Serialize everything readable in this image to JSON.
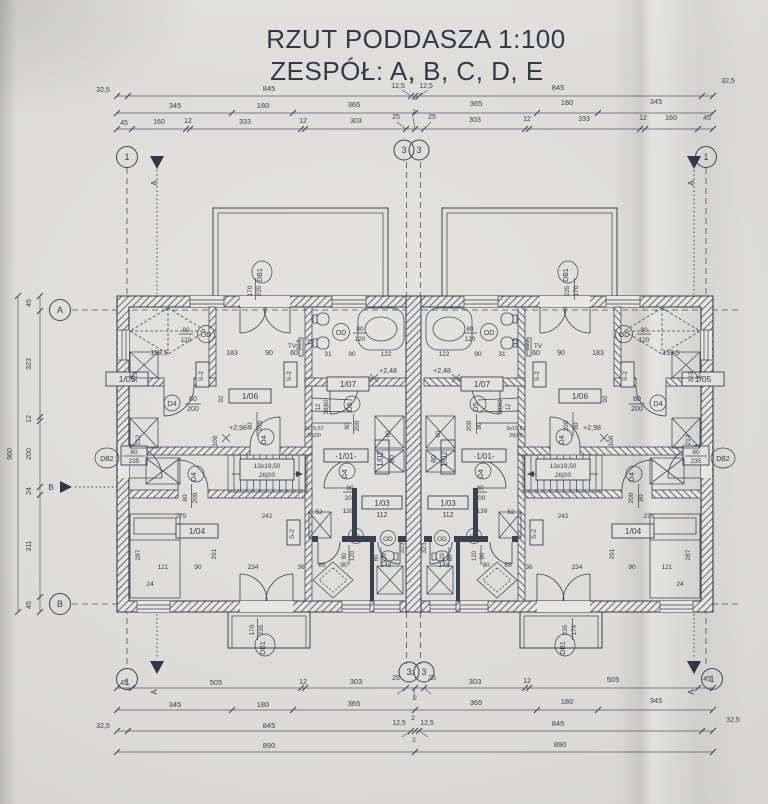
{
  "title": {
    "line1": "RZUT PODDASZA 1:100",
    "line2": "ZESPÓŁ: A, B, C, D, E"
  },
  "colors": {
    "ink": "#39404e",
    "paper": "#dcdbd8",
    "wall_hatch": "#4b5263"
  },
  "axes": {
    "n1": "1",
    "n3": "3",
    "a": "A",
    "b": "B"
  },
  "sections": {
    "a": "A",
    "b": "B"
  },
  "doors": {
    "db1": {
      "code": "DB1",
      "w": "170",
      "h": "235"
    },
    "db2": {
      "code": "DB2",
      "w": "80",
      "h": "235"
    },
    "d4": {
      "code": "D4",
      "w": "80",
      "h": "200"
    },
    "d5": {
      "code": "D5",
      "w": "80",
      "h": "200"
    },
    "od": {
      "code": "OD",
      "w": "80",
      "h": "120"
    }
  },
  "rooms": {
    "r101": "-1/01-",
    "r102": "1/02",
    "r103": "1/03",
    "r104": "1/04",
    "r105": "1/05",
    "r106": "1/06",
    "r107": "1/07"
  },
  "stairs": {
    "main": {
      "steps": "13x19,50",
      "tread": "26|00"
    },
    "winder": {
      "steps": "3x15,67",
      "tread": "26|00"
    }
  },
  "levels": {
    "upper": "+2,98",
    "lower": "+2,48"
  },
  "misc": {
    "tv": "TV",
    "s2": "S-2"
  },
  "dims": {
    "top1": [
      "32,5",
      "845",
      "12,5",
      "2",
      "12,5",
      "845",
      "32,5"
    ],
    "top2": [
      "345",
      "180",
      "365",
      "2",
      "365",
      "180",
      "345"
    ],
    "top3": [
      "45",
      "160",
      "12",
      "333",
      "12",
      "303",
      "25",
      "2",
      "25",
      "303",
      "12",
      "333",
      "12",
      "160",
      "45"
    ],
    "bot1": [
      "45",
      "505",
      "12",
      "303",
      "25",
      "2",
      "25",
      "303",
      "12",
      "505",
      "45"
    ],
    "bot2": [
      "345",
      "180",
      "365",
      "2",
      "365",
      "180",
      "345"
    ],
    "bot3": [
      "32,5",
      "845",
      "12,5",
      "2",
      "12,5",
      "845",
      "32,5"
    ],
    "bot4": [
      "890",
      "2",
      "890"
    ],
    "left": [
      "45",
      "323",
      "12",
      "200",
      "24",
      "311",
      "45"
    ],
    "left_total": "960",
    "i": {
      "v12": "12",
      "v24": "24",
      "v31": "31",
      "v36": "36",
      "v52": "52",
      "v60": "60",
      "v65": "65",
      "v80": "80",
      "v90": "90",
      "v92": "92",
      "v100": "100",
      "v112": "112",
      "v121": "121",
      "v122": "122",
      "v139": "139",
      "v148": "148",
      "v159": "159,5",
      "v183": "183",
      "v212": "212",
      "v223": "223",
      "v234": "234",
      "v242": "242",
      "v275": "275",
      "v287": "287",
      "v291": "291",
      "v323": "323",
      "v3860": "38|60"
    }
  }
}
